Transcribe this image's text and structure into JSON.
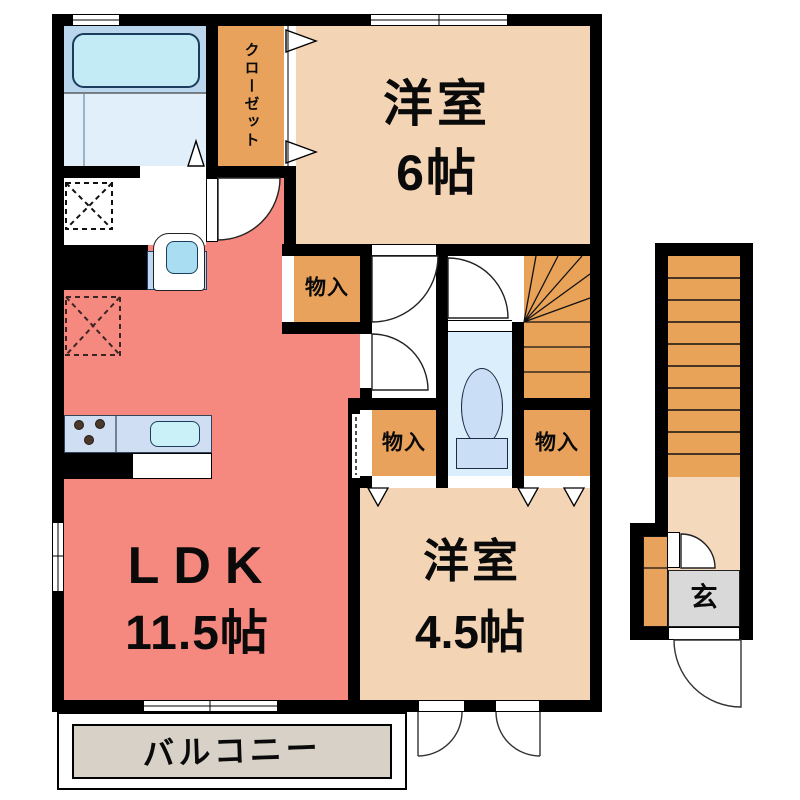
{
  "plan_title": "apartment-floor-plan",
  "rooms": {
    "bedroom6": {
      "name": "洋室",
      "size": "6帖"
    },
    "bedroom45": {
      "name": "洋室",
      "size": "4.5帖"
    },
    "ldk": {
      "name": "LDK",
      "size": "11.5帖"
    },
    "closet": {
      "label": "クローゼット"
    },
    "storage_upper": {
      "label": "物入"
    },
    "storage_lower_left": {
      "label": "物入"
    },
    "storage_lower_right": {
      "label": "物入"
    },
    "balcony": {
      "label": "バルコニー"
    },
    "entrance": {
      "label": "玄"
    }
  },
  "stairs": {
    "indoor_winder_steps": 6,
    "indoor_straight_steps": 3,
    "outdoor_steps": 10
  },
  "colors": {
    "wall": "#000000",
    "ldk": "#f5887f",
    "room": "#f3d4b5",
    "storage": "#e9a25b",
    "stairs": "#e8a358",
    "landing": "#f4d9bd",
    "balcony-floor": "#d8d1c7",
    "genkan": "#d9d9d9",
    "bath-upper": "#b9d6ec",
    "bath-lower": "#e0effa",
    "bathtub": "#c2ebf5",
    "counter": "#cfdef2",
    "sink": "#c9f1f7",
    "basin-unit": "#bdd9f0",
    "basin": "#a9ddf2",
    "toilet-room": "#dbeefb",
    "toilet-fixture": "#cadef5"
  }
}
